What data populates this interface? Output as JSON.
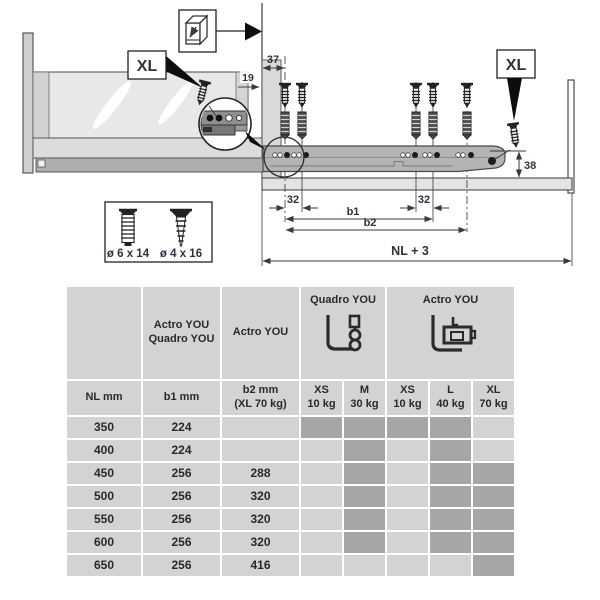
{
  "diagram": {
    "xl_label": "XL",
    "dims": {
      "d37": "37",
      "d19": "19",
      "d32a": "32",
      "d32b": "32",
      "b1": "b1",
      "b2": "b2",
      "d38": "38",
      "nl3": "NL + 3"
    },
    "screw_legend": {
      "small": "ø 6 x 14",
      "large": "ø 4 x 16"
    },
    "colors": {
      "line": "#3a3a3a",
      "dim_text": "#2c3340",
      "rail": "#b4b4b4",
      "panel": "#d9d9d9"
    }
  },
  "table": {
    "header": {
      "col_b1_line1": "Actro YOU",
      "col_b1_line2": "Quadro YOU",
      "col_b2": "Actro YOU",
      "group_quadro": "Quadro YOU",
      "group_actro": "Actro YOU"
    },
    "subheader": {
      "nl": "NL mm",
      "b1": "b1 mm",
      "b2_line1": "b2 mm",
      "b2_line2": "(XL 70 kg)"
    },
    "size_cols": [
      {
        "size": "XS",
        "load": "10 kg"
      },
      {
        "size": "M",
        "load": "30 kg"
      },
      {
        "size": "XS",
        "load": "10 kg"
      },
      {
        "size": "L",
        "load": "40 kg"
      },
      {
        "size": "XL",
        "load": "70 kg"
      }
    ],
    "rows": [
      {
        "nl": "350",
        "b1": "224",
        "b2": "",
        "avail": [
          true,
          true,
          true,
          true,
          false
        ]
      },
      {
        "nl": "400",
        "b1": "224",
        "b2": "",
        "avail": [
          false,
          true,
          false,
          true,
          false
        ]
      },
      {
        "nl": "450",
        "b1": "256",
        "b2": "288",
        "avail": [
          false,
          true,
          false,
          true,
          true
        ]
      },
      {
        "nl": "500",
        "b1": "256",
        "b2": "320",
        "avail": [
          false,
          true,
          false,
          true,
          true
        ]
      },
      {
        "nl": "550",
        "b1": "256",
        "b2": "320",
        "avail": [
          false,
          true,
          false,
          true,
          true
        ]
      },
      {
        "nl": "600",
        "b1": "256",
        "b2": "320",
        "avail": [
          false,
          true,
          false,
          true,
          true
        ]
      },
      {
        "nl": "650",
        "b1": "256",
        "b2": "416",
        "avail": [
          false,
          false,
          false,
          false,
          true
        ]
      }
    ],
    "colors": {
      "cell_light": "#d3d3d3",
      "cell_dark": "#a6a6a6",
      "text": "#26292e"
    }
  }
}
